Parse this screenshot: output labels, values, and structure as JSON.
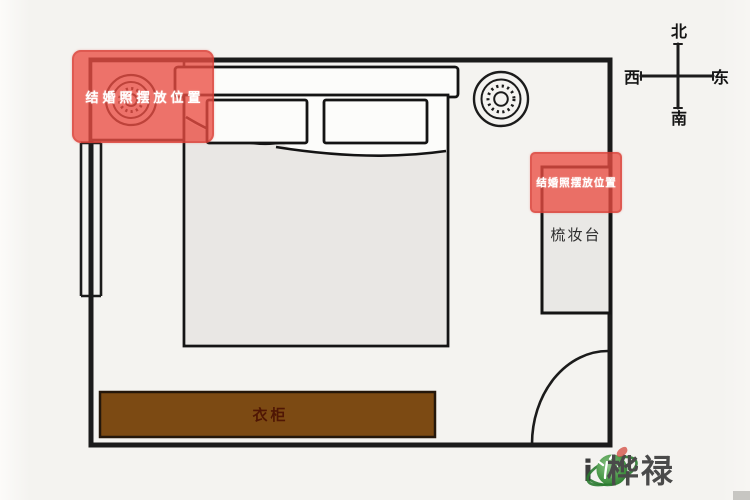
{
  "diagram": {
    "type": "bedroom-fengshui-floorplan",
    "highlight_left": {
      "label": "结婚照摆放位置"
    },
    "highlight_right": {
      "label": "结婚照摆放位置"
    },
    "vanity_label": "梳妆台",
    "wardrobe_label": "衣柜"
  },
  "compass": {
    "north": "北",
    "south": "南",
    "east": "东",
    "west": "西"
  },
  "logo": {
    "prefix": "i",
    "separator": "-",
    "brand": "桦禄",
    "icon": "globe-bamboo-icon"
  },
  "colors": {
    "highlight_red": "#ea4d42",
    "wardrobe_brown": "#7c4a13",
    "wardrobe_text": "#4f1604",
    "wall_black": "#1b1b1b",
    "mattress_gray": "#e9e7e4",
    "logo_green": "#2a7a30",
    "logo_text_gray": "#4a4a4a"
  }
}
